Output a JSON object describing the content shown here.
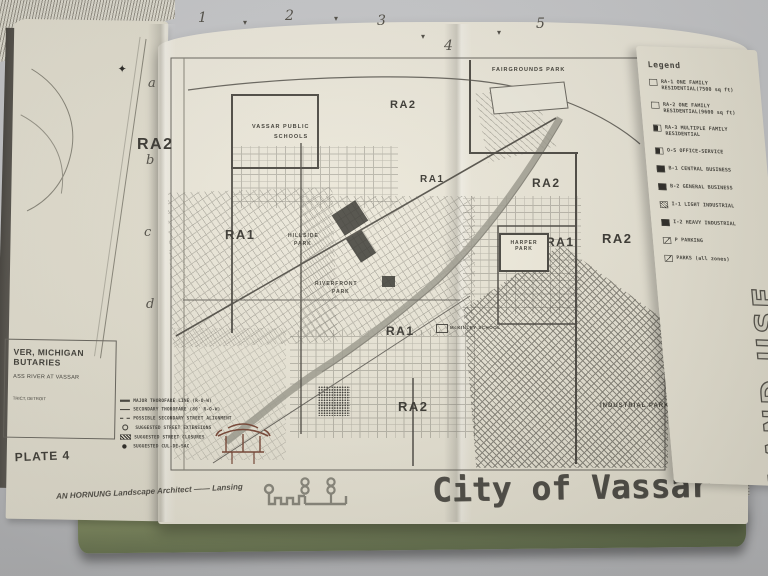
{
  "left_page": {
    "caption": {
      "line1": "VER, MICHIGAN",
      "line2": "BUTARIES",
      "line3": "ASS RIVER AT VASSAR",
      "line4": "TRICT, DETROIT"
    },
    "plate_label": "PLATE 4"
  },
  "grid_index": {
    "n1": "1",
    "n2": "2",
    "n3": "3",
    "n4": "4",
    "n5": "5",
    "la": "a",
    "lb": "b",
    "lc": "c",
    "ld": "d"
  },
  "icons": {
    "tick": "▾",
    "compass": "✦"
  },
  "map": {
    "zone_labels": {
      "z1": "RA2",
      "z2": "RA2",
      "z3": "RA1",
      "z4": "RA2",
      "z5": "RA1",
      "z6": "RA1",
      "z7": "RA2",
      "z8": "RA1",
      "z9": "RA2"
    },
    "places": {
      "fairgrounds": "FAIRGROUNDS PARK",
      "schools_l1": "VASSAR PUBLIC",
      "schools_l2": "SCHOOLS",
      "hillside_l1": "HILLSIDE",
      "hillside_l2": "PARK",
      "riverfront_l1": "RIVERFRONT",
      "riverfront_l2": "PARK",
      "harper_l1": "HARPER",
      "harper_l2": "PARK",
      "school_small": "McKINLEY SCHOOL",
      "industrial": "INDUSTRIAL PARK"
    },
    "key": {
      "k1": "MAJOR THOROFARE LINE (R-O-W)",
      "k2": "SECONDARY THOROFARE (80' R-O-W)",
      "k3": "POSSIBLE SECONDARY STREET ALIGNMENT",
      "k4": "SUGGESTED STREET EXTENSIONS",
      "k5": "SUGGESTED STREET CLOSURES",
      "k6": "SUGGESTED CUL-DE-SAC"
    },
    "credit": "AN HORNUNG  Landscape Architect —— Lansing",
    "title": "City of Vassar"
  },
  "legend": {
    "title": "Legend",
    "items": [
      "RA-1 ONE FAMILY RESIDENTIAL(7500 sq ft)",
      "RA-2 ONE FAMILY RESIDENTIAL(9600 sq ft)",
      "RA-3 MULTIPLE FAMILY RESIDENTIAL",
      "O-S OFFICE-SERVICE",
      "B-1 CENTRAL BUSINESS",
      "B-2 GENERAL BUSINESS",
      "I-1 LIGHT INDUSTRIAL",
      "I-2 HEAVY INDUSTRIAL",
      "P PARKING",
      "PARKS (all zones)"
    ]
  },
  "side_label": "LAND USE",
  "colors": {
    "page": "#ece8da",
    "ink": "#4a4843",
    "cover_green": "#6e7d58",
    "table": "#c6c7c9"
  }
}
